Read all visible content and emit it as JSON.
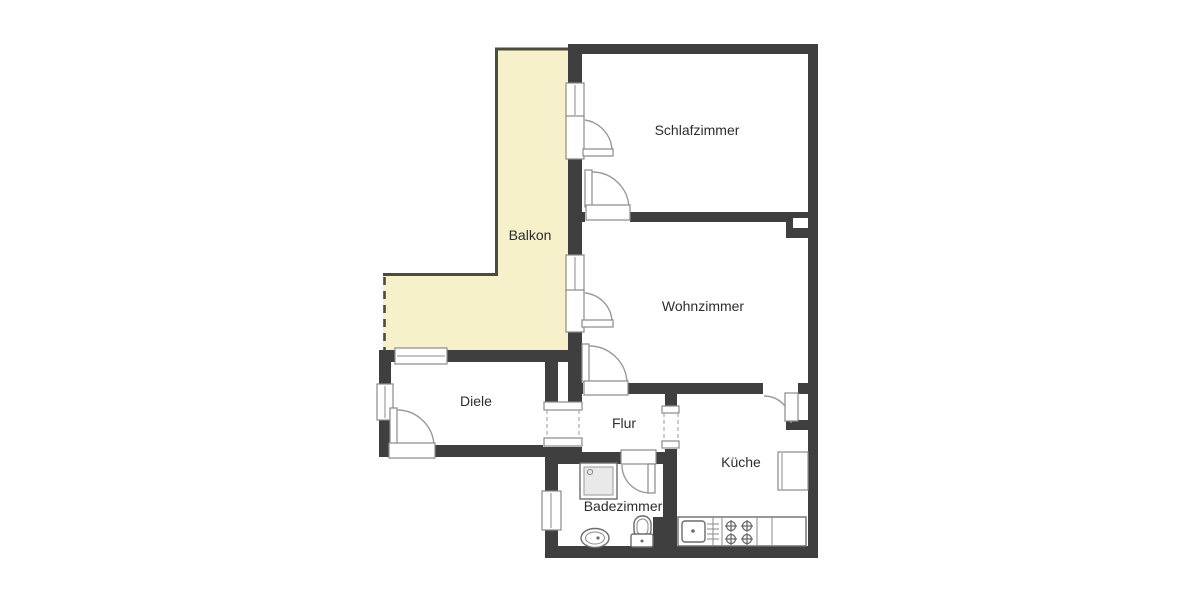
{
  "floorplan": {
    "rooms": {
      "balkon": "Balkon",
      "schlafzimmer": "Schlafzimmer",
      "wohnzimmer": "Wohnzimmer",
      "diele": "Diele",
      "flur": "Flur",
      "kueche": "Küche",
      "badezimmer": "Badezimmer"
    },
    "fixtures": [
      "shower",
      "washbasin",
      "toilet",
      "kitchen-sink",
      "stove",
      "kitchen-counter",
      "kitchen-appliance"
    ],
    "colors": {
      "wall": "#3f3f3f",
      "balcony_fill": "#f6f1cb",
      "balcony_outline": "#4b4b40",
      "casing": "#8a8a8a",
      "arc": "#9a9a9a",
      "fixture": "#6b6b6b",
      "text": "#2d2d2d",
      "background": "#ffffff"
    }
  }
}
